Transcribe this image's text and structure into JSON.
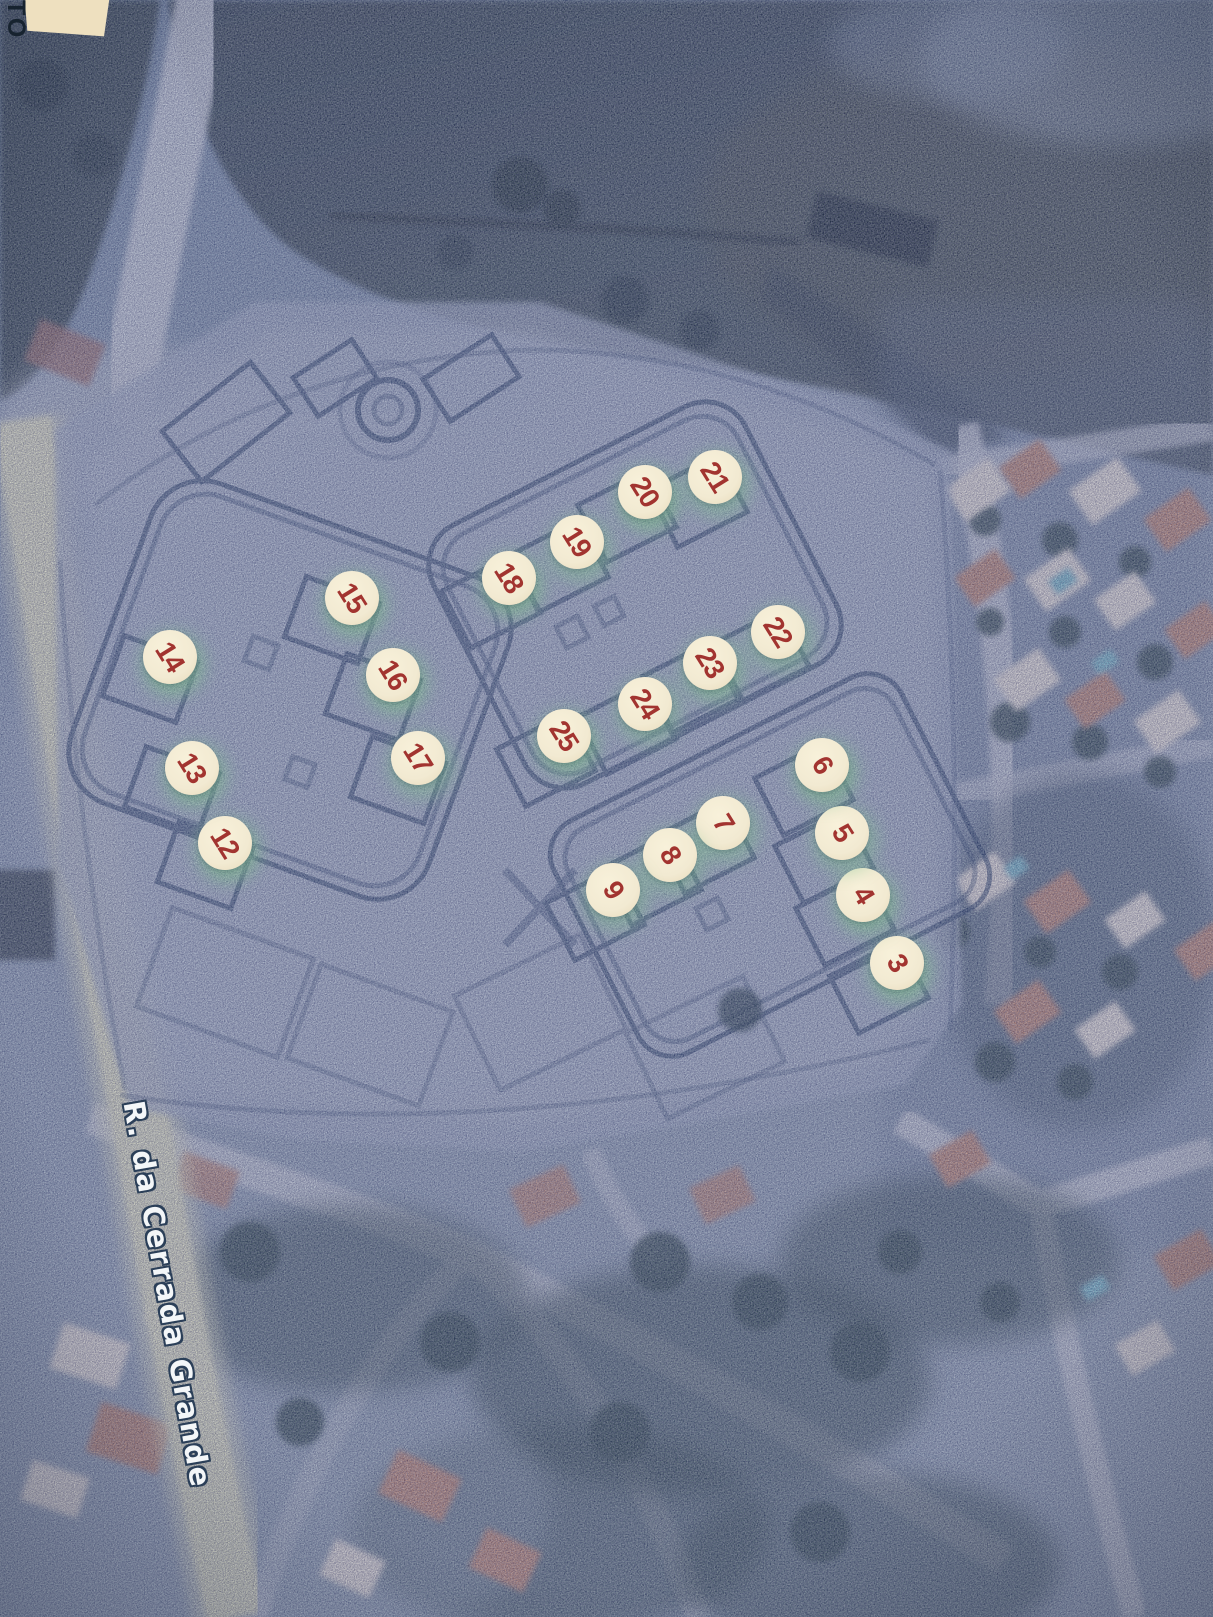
{
  "scene": {
    "street_label": "R. da Cerrada Grande",
    "corner_label": "TO"
  },
  "markers": [
    {
      "label": "3",
      "x": 897,
      "y": 963
    },
    {
      "label": "4",
      "x": 863,
      "y": 895
    },
    {
      "label": "5",
      "x": 842,
      "y": 833
    },
    {
      "label": "6",
      "x": 822,
      "y": 765
    },
    {
      "label": "7",
      "x": 723,
      "y": 823
    },
    {
      "label": "8",
      "x": 670,
      "y": 855
    },
    {
      "label": "9",
      "x": 613,
      "y": 890
    },
    {
      "label": "12",
      "x": 225,
      "y": 843
    },
    {
      "label": "13",
      "x": 192,
      "y": 768
    },
    {
      "label": "14",
      "x": 170,
      "y": 657
    },
    {
      "label": "15",
      "x": 352,
      "y": 598
    },
    {
      "label": "16",
      "x": 393,
      "y": 675
    },
    {
      "label": "17",
      "x": 418,
      "y": 758
    },
    {
      "label": "18",
      "x": 509,
      "y": 578
    },
    {
      "label": "19",
      "x": 577,
      "y": 542
    },
    {
      "label": "20",
      "x": 645,
      "y": 492
    },
    {
      "label": "21",
      "x": 715,
      "y": 477
    },
    {
      "label": "22",
      "x": 778,
      "y": 632
    },
    {
      "label": "23",
      "x": 710,
      "y": 663
    },
    {
      "label": "24",
      "x": 645,
      "y": 704
    },
    {
      "label": "25",
      "x": 564,
      "y": 736
    }
  ],
  "colors": {
    "marker_fill": "#f2ead2",
    "marker_number": "#a23430",
    "marker_glow": "#8fce9b",
    "plan_ink": "#1d3a60",
    "plan_paper": "#a3b3c6",
    "satellite_base": "#8499af",
    "field_dark": "#31464d",
    "road_pale": "#ccd5dd",
    "road_yellow": "#e3e6c3",
    "street_label_fill": "#f3f6f8",
    "street_label_outline": "#2b3f58",
    "corner_paper": "#eee0bf",
    "corner_text": "#17232f",
    "roof_terracotta": "#bd8a72",
    "roof_white": "#e7e4d9",
    "pool_cyan": "#77bdca",
    "vegetation_dark": "#2f4a4b"
  }
}
